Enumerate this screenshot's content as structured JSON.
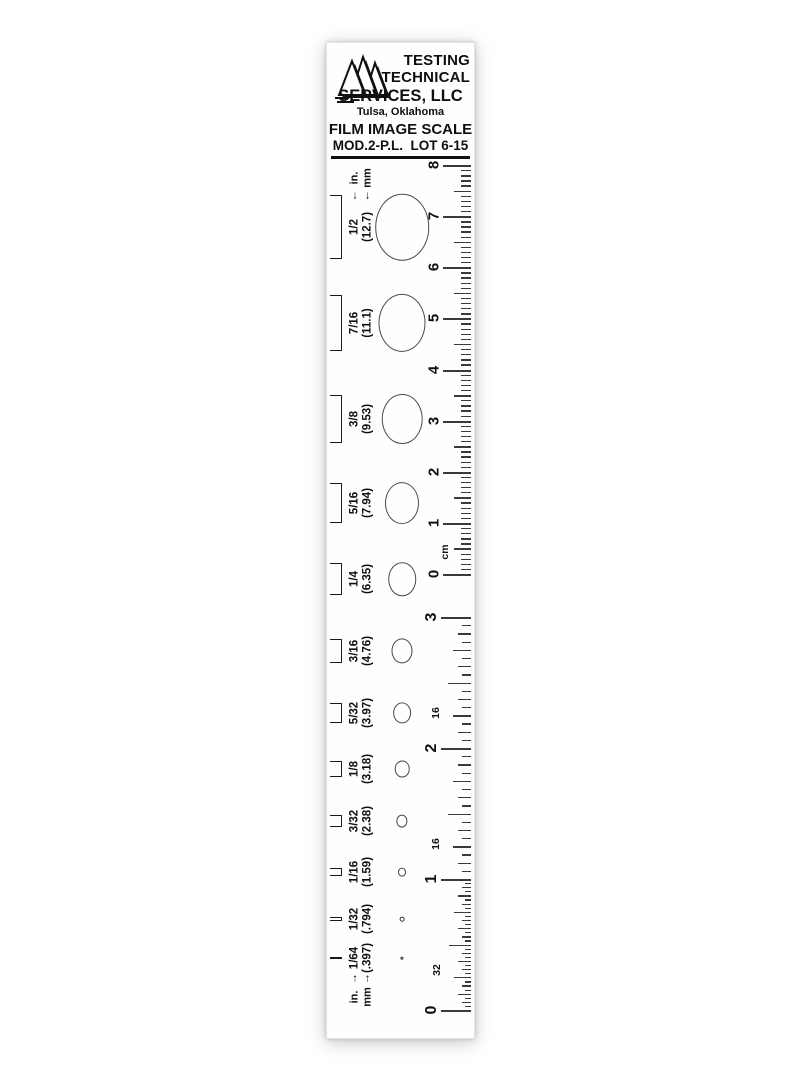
{
  "header": {
    "company_line1": "TESTING",
    "company_line2": "TECHNICAL",
    "company_line3": "SERVICES, LLC",
    "location": "Tulsa, Oklahoma",
    "product_title": "FILM IMAGE SCALE",
    "model_lot": "MOD.2-P.L.  LOT 6-15"
  },
  "legend_top": {
    "in_label": "in.",
    "mm_label": "mm",
    "arrow": "↓"
  },
  "legend_bottom": {
    "in_label": "in.",
    "mm_label": "mm",
    "arrow": "↑"
  },
  "rows": [
    {
      "fraction": "1/2",
      "mm_label": "(12.7)",
      "mm": 12.7
    },
    {
      "fraction": "7/16",
      "mm_label": "(11.1)",
      "mm": 11.1
    },
    {
      "fraction": "3/8",
      "mm_label": "(9.53)",
      "mm": 9.53
    },
    {
      "fraction": "5/16",
      "mm_label": "(7.94)",
      "mm": 7.94
    },
    {
      "fraction": "1/4",
      "mm_label": "(6.35)",
      "mm": 6.35
    },
    {
      "fraction": "3/16",
      "mm_label": "(4.76)",
      "mm": 4.76
    },
    {
      "fraction": "5/32",
      "mm_label": "(3.97)",
      "mm": 3.97
    },
    {
      "fraction": "1/8",
      "mm_label": "(3.18)",
      "mm": 3.18
    },
    {
      "fraction": "3/32",
      "mm_label": "(2.38)",
      "mm": 2.38
    },
    {
      "fraction": "1/16",
      "mm_label": "(1.59)",
      "mm": 1.59
    },
    {
      "fraction": "1/32",
      "mm_label": "(.794)",
      "mm": 0.794
    },
    {
      "fraction": "1/64",
      "mm_label": "(.397)",
      "mm": 0.397
    }
  ],
  "cm_scale": {
    "unit": "cm",
    "numbers": [
      "8",
      "7",
      "6",
      "5",
      "4",
      "3",
      "2",
      "1",
      "0"
    ]
  },
  "inch_scale": {
    "numbers": [
      "3",
      "2",
      "1",
      "0"
    ],
    "denominators": [
      "16",
      "16",
      "32"
    ]
  }
}
